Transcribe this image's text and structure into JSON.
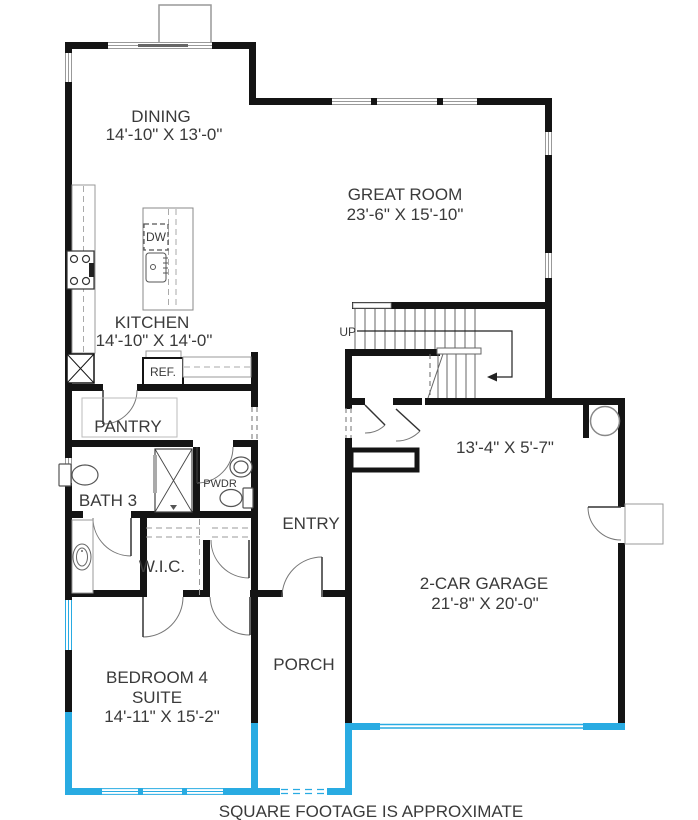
{
  "footer": "SQUARE FOOTAGE IS APPROXIMATE",
  "rooms": {
    "dining": {
      "label": "DINING",
      "dims": "14'-10\" X 13'-0\""
    },
    "great_room": {
      "label": "GREAT ROOM",
      "dims": "23'-6\" X 15'-10\""
    },
    "kitchen": {
      "label": "KITCHEN",
      "dims": "14'-10\" X 14'-0\""
    },
    "pantry": {
      "label": "PANTRY"
    },
    "bath3": {
      "label": "BATH 3"
    },
    "powder": {
      "label": "PWDR"
    },
    "entry": {
      "label": "ENTRY"
    },
    "wic": {
      "label": "W.I.C."
    },
    "flex": {
      "dims": "13'-4\" X 5'-7\""
    },
    "garage": {
      "label": "2-CAR GARAGE",
      "dims": "21'-8\" X 20'-0\""
    },
    "bedroom4": {
      "label": "BEDROOM 4",
      "sublabel": "SUITE",
      "dims": "14'-11\" X 15'-2\""
    },
    "porch": {
      "label": "PORCH"
    }
  },
  "appliances": {
    "dishwasher": "DW",
    "refrigerator": "REF."
  },
  "stairs": {
    "direction": "UP"
  },
  "colors": {
    "wall": "#141414",
    "optional_wall": "#29abe2",
    "window": "#999999",
    "text": "#3a3a3a"
  }
}
